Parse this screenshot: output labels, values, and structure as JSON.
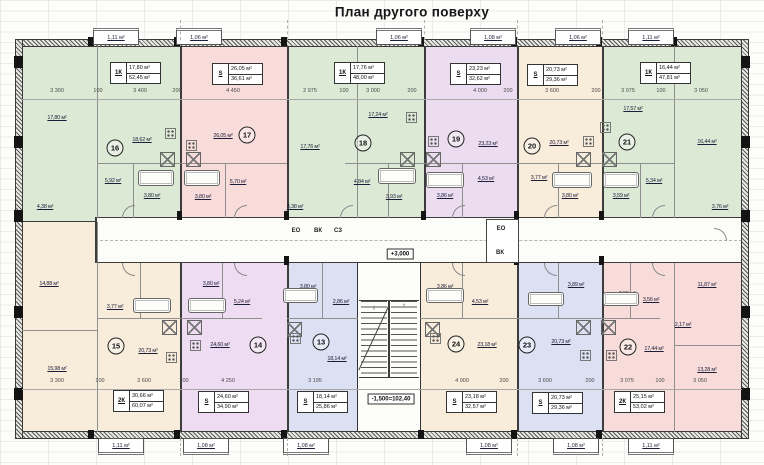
{
  "title": "План другого поверху",
  "corridor": {
    "level": "+3,000",
    "left_shaft": [
      "ЕО",
      "ВК",
      "СЗ"
    ],
    "right_shaft": [
      "ЕО",
      "ВК"
    ]
  },
  "stairs": {
    "level": "-1,500=102,40",
    "up": "↑",
    "down": "↓"
  },
  "units": [
    {
      "num": "16",
      "type": "1К",
      "room_area": "17,80 м²",
      "total_area": "52,45 м²",
      "balcony": "1,11 м²",
      "color": "#dcead5",
      "rooms": [
        "17,80 м²",
        "18,62 м²",
        "5,92 м²",
        "3,80 м²",
        "4,38 м²"
      ]
    },
    {
      "num": "17",
      "type": "S",
      "room_area": "26,05 м²",
      "total_area": "36,61 м²",
      "balcony": "1,06 м²",
      "color": "#f7dcd9",
      "rooms": [
        "26,05 м²",
        "5,70 м²",
        "3,80 м²"
      ]
    },
    {
      "num": "18",
      "type": "1К",
      "room_area": "17,76 м²",
      "total_area": "48,00 м²",
      "balcony": "1,06 м²",
      "color": "#dcead5",
      "rooms": [
        "17,76 м²",
        "17,24 м²",
        "4,84 м²",
        "3,93 м²",
        "3,38 м²"
      ]
    },
    {
      "num": "19",
      "type": "S",
      "room_area": "23,23 м²",
      "total_area": "32,62 м²",
      "balcony": "1,08 м²",
      "color": "#ecdcf0",
      "rooms": [
        "23,23 м²",
        "4,53 м²",
        "3,86 м²"
      ]
    },
    {
      "num": "20",
      "type": "S",
      "room_area": "20,73 м²",
      "total_area": "29,36 м²",
      "balcony": "1,06 м²",
      "color": "#f8ecda",
      "rooms": [
        "20,73 м²",
        "3,77 м²",
        "3,80 м²"
      ]
    },
    {
      "num": "21",
      "type": "1К",
      "room_area": "16,44 м²",
      "total_area": "47,81 м²",
      "balcony": "1,11 м²",
      "color": "#dcead5",
      "rooms": [
        "17,57 м²",
        "16,44 м²",
        "5,34 м²",
        "3,59 м²",
        "3,76 м²"
      ]
    },
    {
      "num": "15",
      "type": "2К",
      "room_area": "30,66 м²",
      "total_area": "60,07 м²",
      "balcony": "1,11 м²",
      "color": "#f8ecda",
      "rooms": [
        "14,88 м²",
        "15,98 м²",
        "20,73 м²",
        "3,77 м²"
      ]
    },
    {
      "num": "14",
      "type": "S",
      "room_area": "24,60 м²",
      "total_area": "34,90 м²",
      "balcony": "1,08 м²",
      "color": "#eedcf2",
      "rooms": [
        "24,60 м²",
        "5,24 м²",
        "3,80 м²"
      ]
    },
    {
      "num": "13",
      "type": "S",
      "room_area": "18,14 м²",
      "total_area": "25,86 м²",
      "balcony": "1,08 м²",
      "color": "#dbe0f3",
      "rooms": [
        "18,14 м²",
        "3,80 м²",
        "2,86 м²"
      ]
    },
    {
      "num": "24",
      "type": "S",
      "room_area": "23,18 м²",
      "total_area": "32,57 м²",
      "balcony": "1,08 м²",
      "color": "#f8ecda",
      "rooms": [
        "23,18 м²",
        "3,86 м²",
        "4,53 м²"
      ]
    },
    {
      "num": "23",
      "type": "S",
      "room_area": "20,73 м²",
      "total_area": "29,36 м²",
      "balcony": "1,08 м²",
      "color": "#dbe0f3",
      "rooms": [
        "20,73 м²",
        "3,89 м²",
        "3,77 м²"
      ]
    },
    {
      "num": "22",
      "type": "2К",
      "room_area": "25,15 м²",
      "total_area": "53,02 м²",
      "balcony": "1,11 м²",
      "color": "#f7dcd9",
      "rooms": [
        "17,44 м²",
        "11,87 м²",
        "13,28 м²",
        "2,17 м²",
        "3,59 м²",
        "3,56 м²"
      ]
    }
  ],
  "dims_top": [
    "3 300",
    "100",
    "3 400",
    "200",
    "4 450",
    "2 975",
    "100",
    "3 000",
    "200",
    "4 000",
    "200",
    "3 600",
    "200",
    "3 075",
    "100",
    "3 050"
  ],
  "dims_bottom": [
    "3 300",
    "100",
    "3 600",
    "200",
    "4 250",
    "3 195",
    "4 000",
    "200",
    "3 600",
    "200",
    "3 075",
    "100",
    "3 050"
  ]
}
